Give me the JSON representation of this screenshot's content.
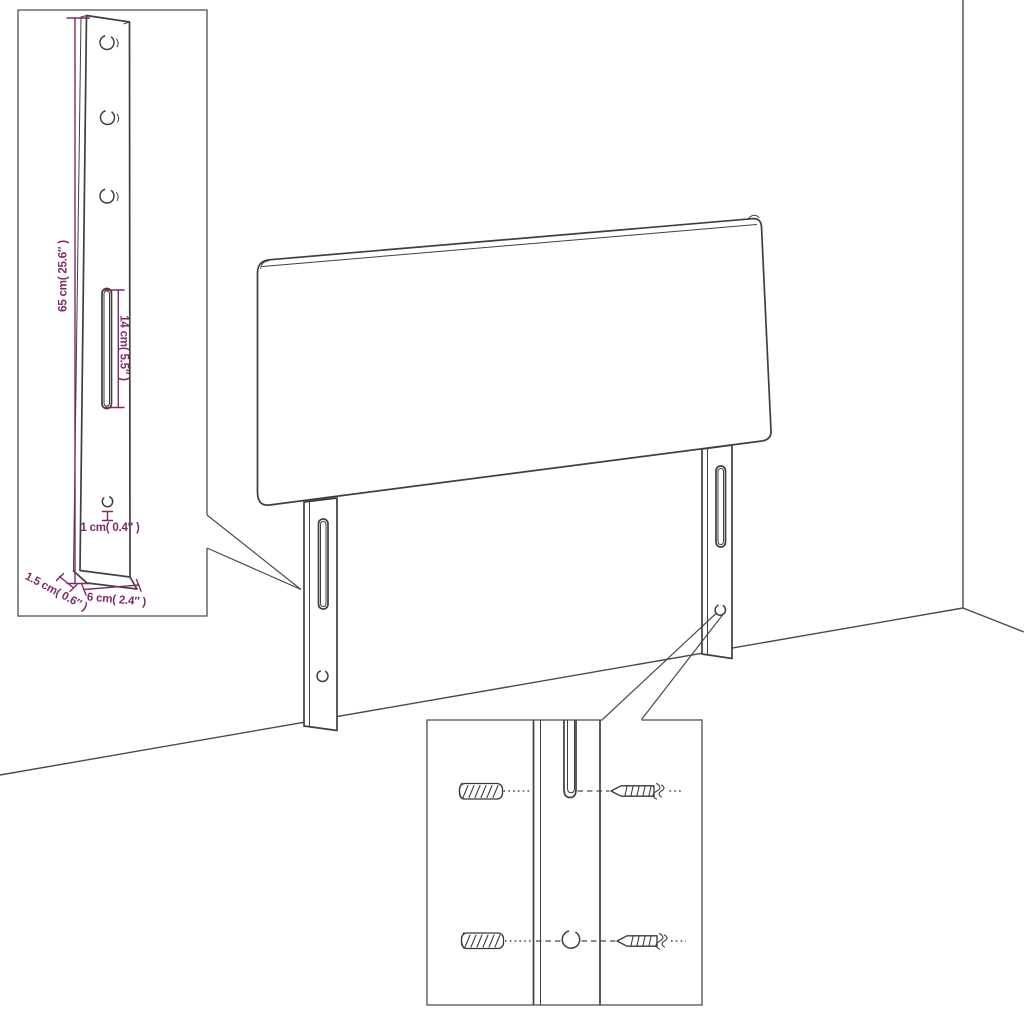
{
  "diagram": {
    "kind": "furniture assembly dimension diagram",
    "subject": "upholstered headboard with two mounting legs",
    "background_color": "#ffffff",
    "line_color": "#3f3f3f",
    "dimension_color": "#7d2b68"
  },
  "leg_detail_inset": {
    "labels": {
      "height": "65 cm( 25.6″ )",
      "slot": "14 cm( 5.5″ )",
      "hole": "1 cm( 0.4″ )",
      "depth": "1.5 cm( 0.6″ )",
      "width": "6 cm( 2.4″ )"
    },
    "features": [
      "three-mounting-holes",
      "adjustment-slot",
      "small-hole",
      "dimension-lines"
    ]
  },
  "hardware_detail_inset": {
    "parts": [
      "wall-plug",
      "wall-plug",
      "screw",
      "screw",
      "leg-slot",
      "leg-hole"
    ],
    "alignment": "dashed guide lines"
  },
  "scene": {
    "parts": [
      "headboard-panel",
      "left-leg",
      "right-leg",
      "wall-corner",
      "floor-line"
    ]
  }
}
